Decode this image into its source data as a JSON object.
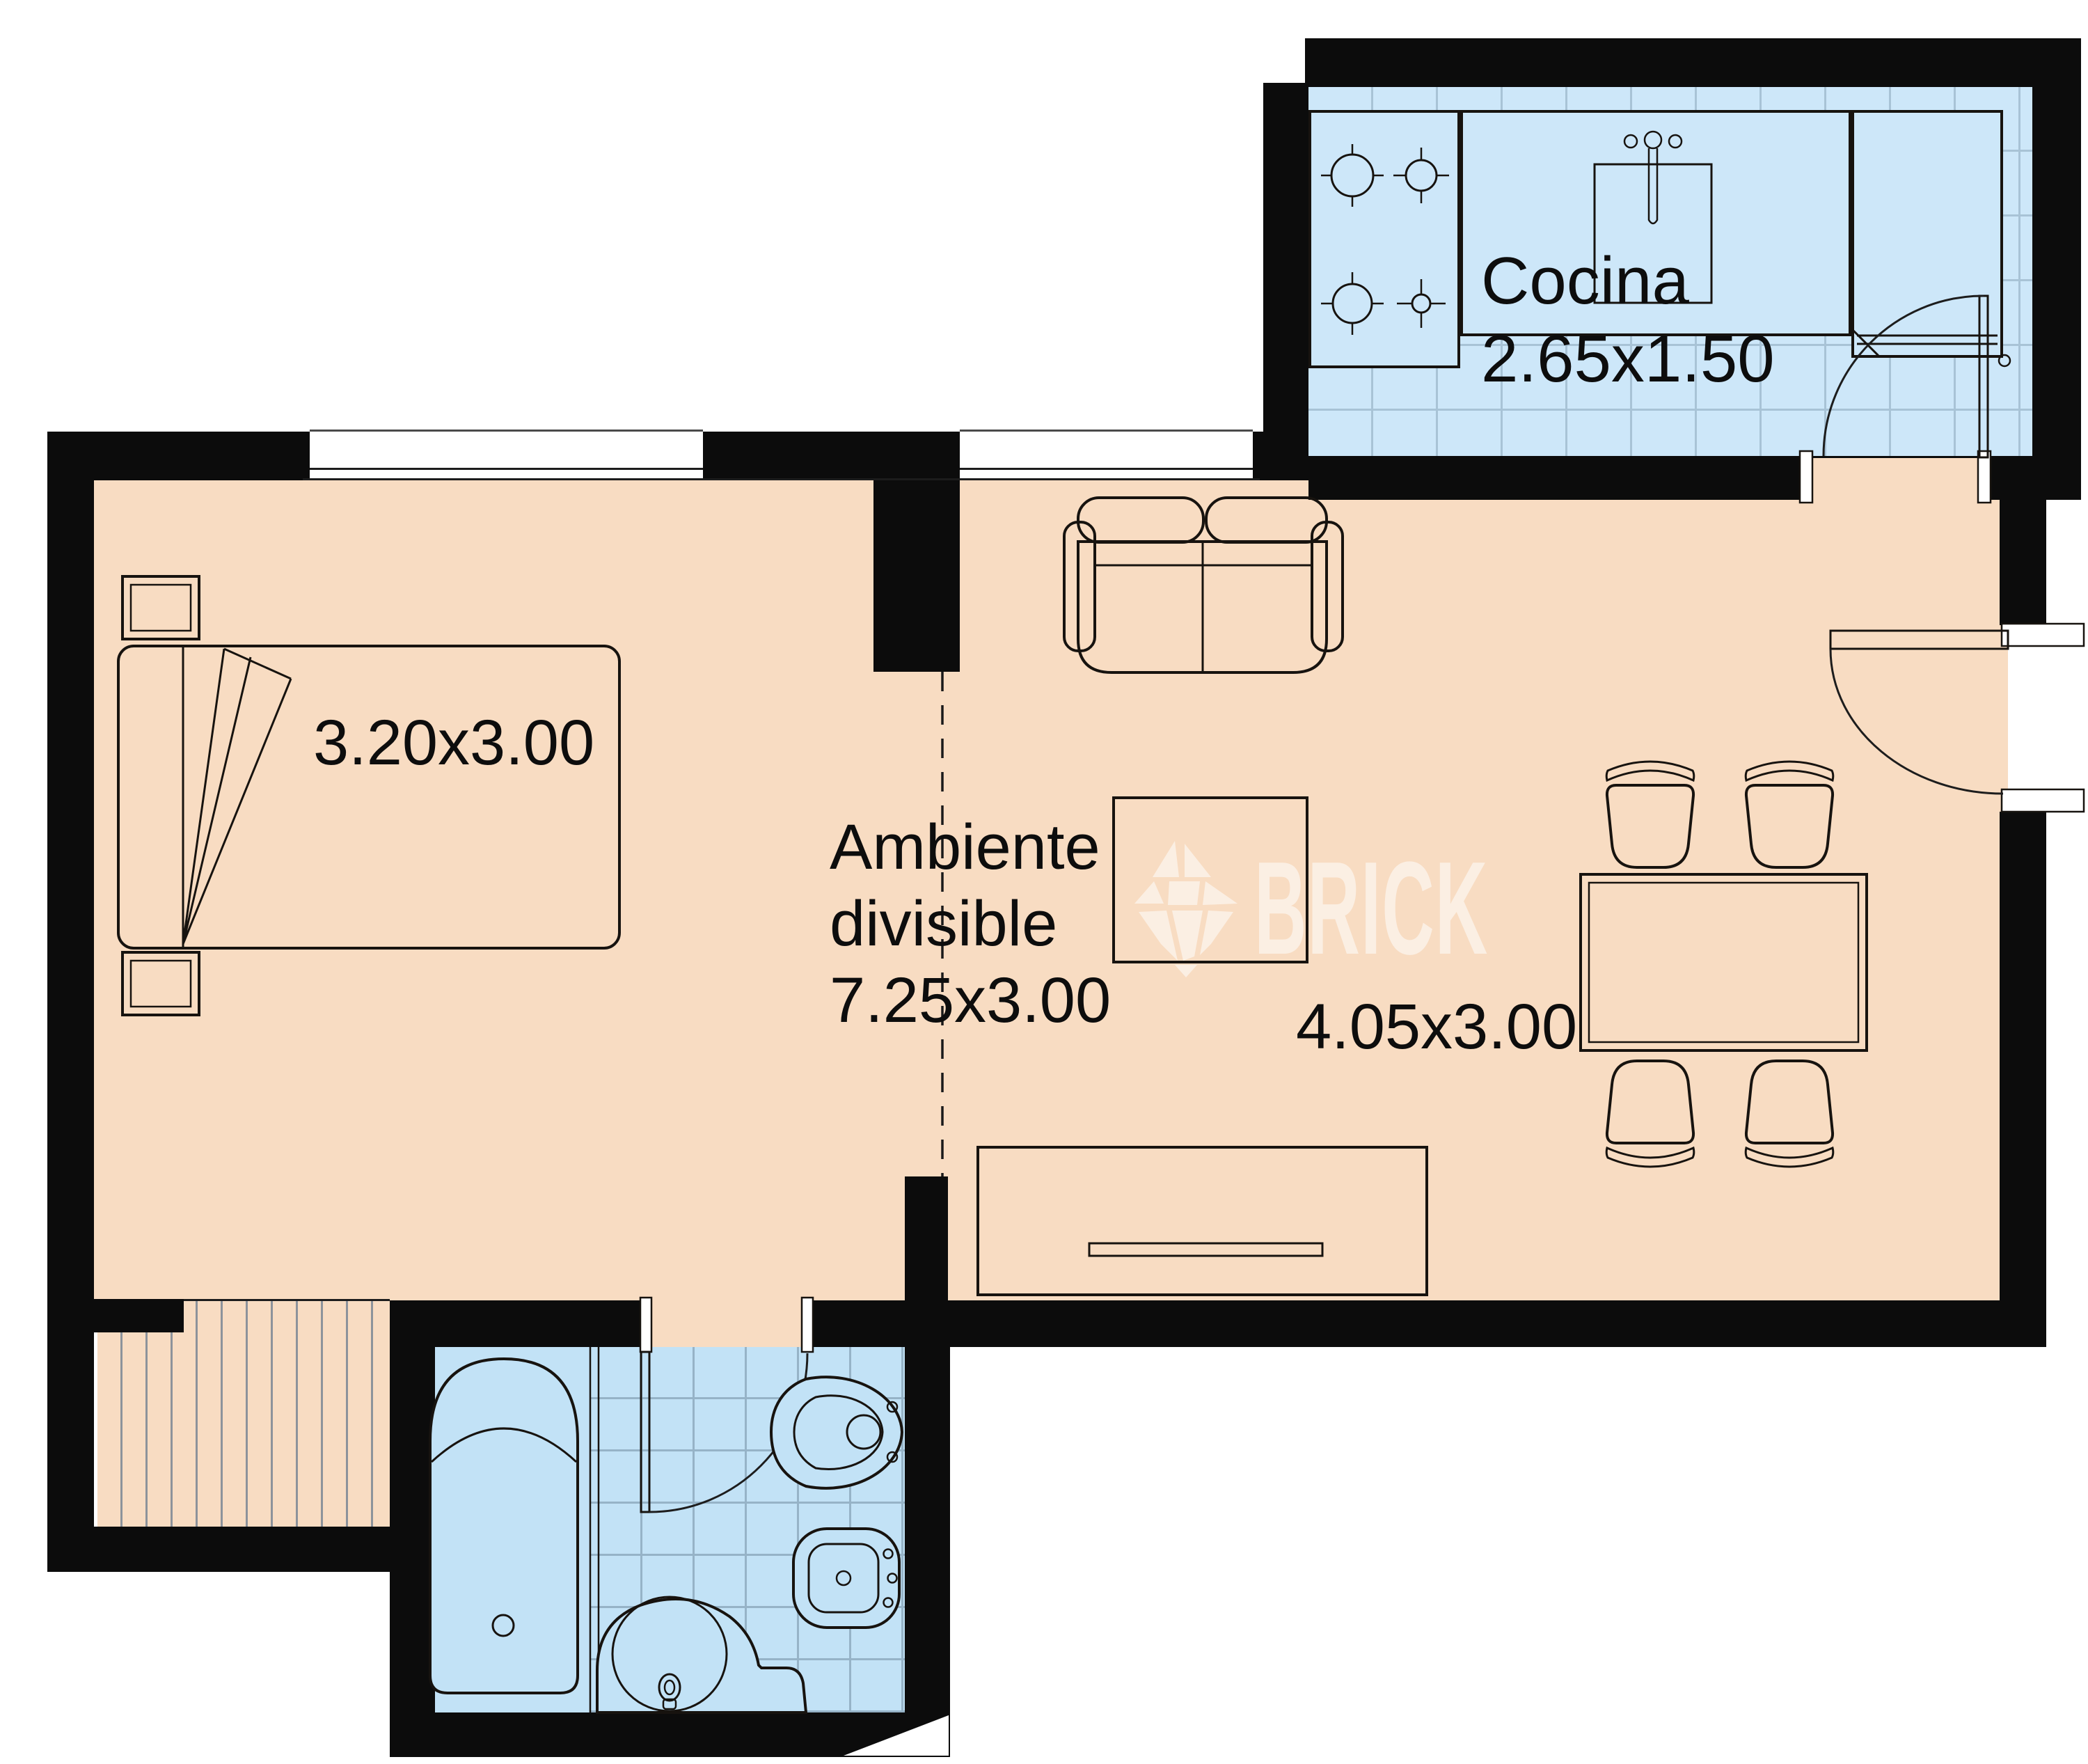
{
  "plan": {
    "watermark": {
      "brand": "BRICK"
    },
    "rooms": {
      "kitchen": {
        "name": "Cocina",
        "dimensions": "2.65x1.50"
      },
      "bedroom": {
        "dimensions": "3.20x3.00"
      },
      "main": {
        "name_line1": "Ambiente",
        "name_line2": "divisible",
        "dimensions": "7.25x3.00"
      },
      "living": {
        "dimensions": "4.05x3.00"
      }
    },
    "colors": {
      "wall": "#0c0c0c",
      "floor_dry": "#f8dcc2",
      "floor_kitchen": "#cde7f9",
      "floor_bathroom": "#c2e2f6",
      "label_text": "#0d0d0d",
      "watermark": "#ffffff"
    },
    "fixtures": {
      "kitchen": [
        "stove",
        "sink-counter",
        "refrigerator"
      ],
      "bathroom": [
        "bathtub",
        "toilet",
        "bidet",
        "washbasin"
      ],
      "bedroom": [
        "double-bed",
        "nightstand",
        "nightstand"
      ],
      "living": [
        "sofa",
        "coffee-table",
        "dining-table",
        "dining-chairs",
        "tv-cabinet"
      ],
      "doors": [
        "kitchen-door",
        "entry-door",
        "bathroom-door"
      ]
    }
  }
}
